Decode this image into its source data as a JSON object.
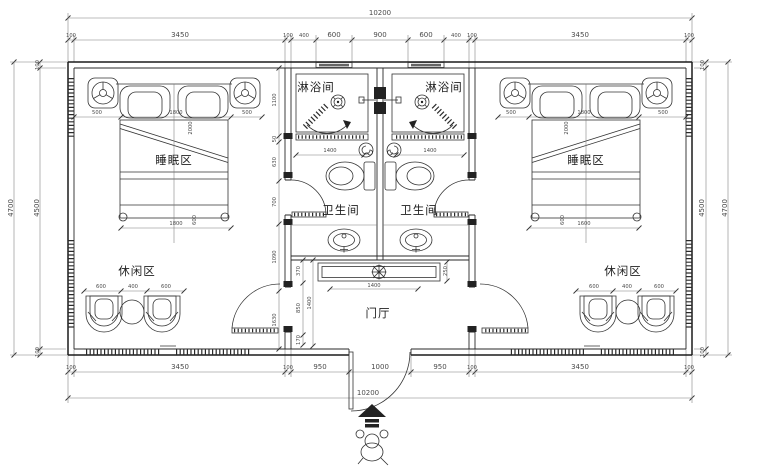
{
  "labels": {
    "sleep": "睡眠区",
    "shower": "淋浴间",
    "toilet": "卫生间",
    "leisure": "休闲区",
    "foyer": "门厅"
  },
  "dims": {
    "overall": "10200",
    "top": [
      "100",
      "3450",
      "100",
      "400",
      "600",
      "900",
      "600",
      "400",
      "100",
      "3450",
      "100"
    ],
    "bottom": [
      "100",
      "3450",
      "100",
      "950",
      "1000",
      "950",
      "100",
      "3450",
      "100"
    ],
    "height_outer": "4700",
    "height_inner": "4500",
    "wall": "100",
    "bed_row": [
      "500",
      "1800",
      "500"
    ],
    "bed_bottom_left": "1800",
    "bed_bottom_right": "1600",
    "bed_length": "2000",
    "bed_width": "600",
    "chair_row": [
      "600",
      "400",
      "600"
    ],
    "toilet_width": "1400",
    "side_chain": [
      "1100",
      "50",
      "630",
      "700",
      "1090",
      "1630"
    ],
    "foyer_chain": [
      "370",
      "850",
      "170"
    ],
    "foyer_height": "1400",
    "cabinet_width": "1400",
    "cabinet_depth": "250"
  }
}
